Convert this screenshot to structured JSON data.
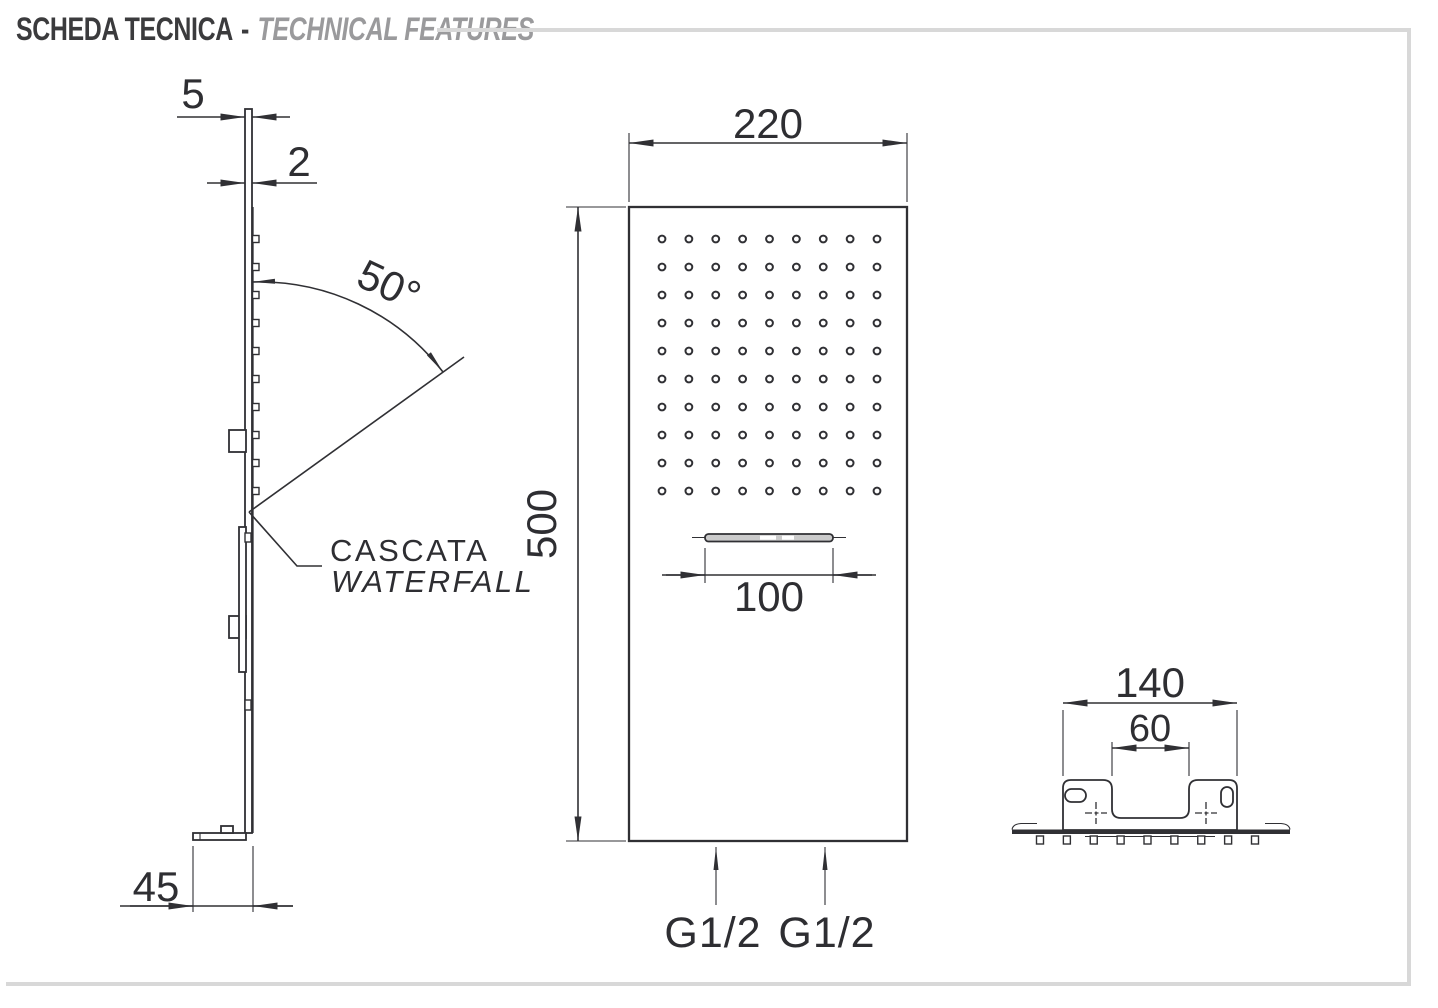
{
  "header": {
    "title": "SCHEDA TECNICA",
    "separator": "-",
    "subtitle": "TECHNICAL FEATURES"
  },
  "side_view": {
    "dim_top_thickness": "5",
    "dim_panel_thickness": "2",
    "dim_angle": "50°",
    "dim_foot_depth": "45",
    "callout": {
      "line1": "CASCATA",
      "line2": "WATERFALL"
    },
    "nozzle_count": 10
  },
  "front_view": {
    "dim_width": "220",
    "dim_height": "500",
    "dim_waterfall_width": "100",
    "inlet_left": "G1/2",
    "inlet_right": "G1/2",
    "nozzle_rows": 10,
    "nozzle_cols": 9
  },
  "top_view": {
    "dim_bracket_width": "140",
    "dim_inner_width": "60",
    "nozzle_count": 9
  },
  "colors": {
    "line": "#303034",
    "title_dark": "#3b3b3d",
    "title_gray": "#9a9a9c",
    "rule": "#d8d8d8"
  }
}
